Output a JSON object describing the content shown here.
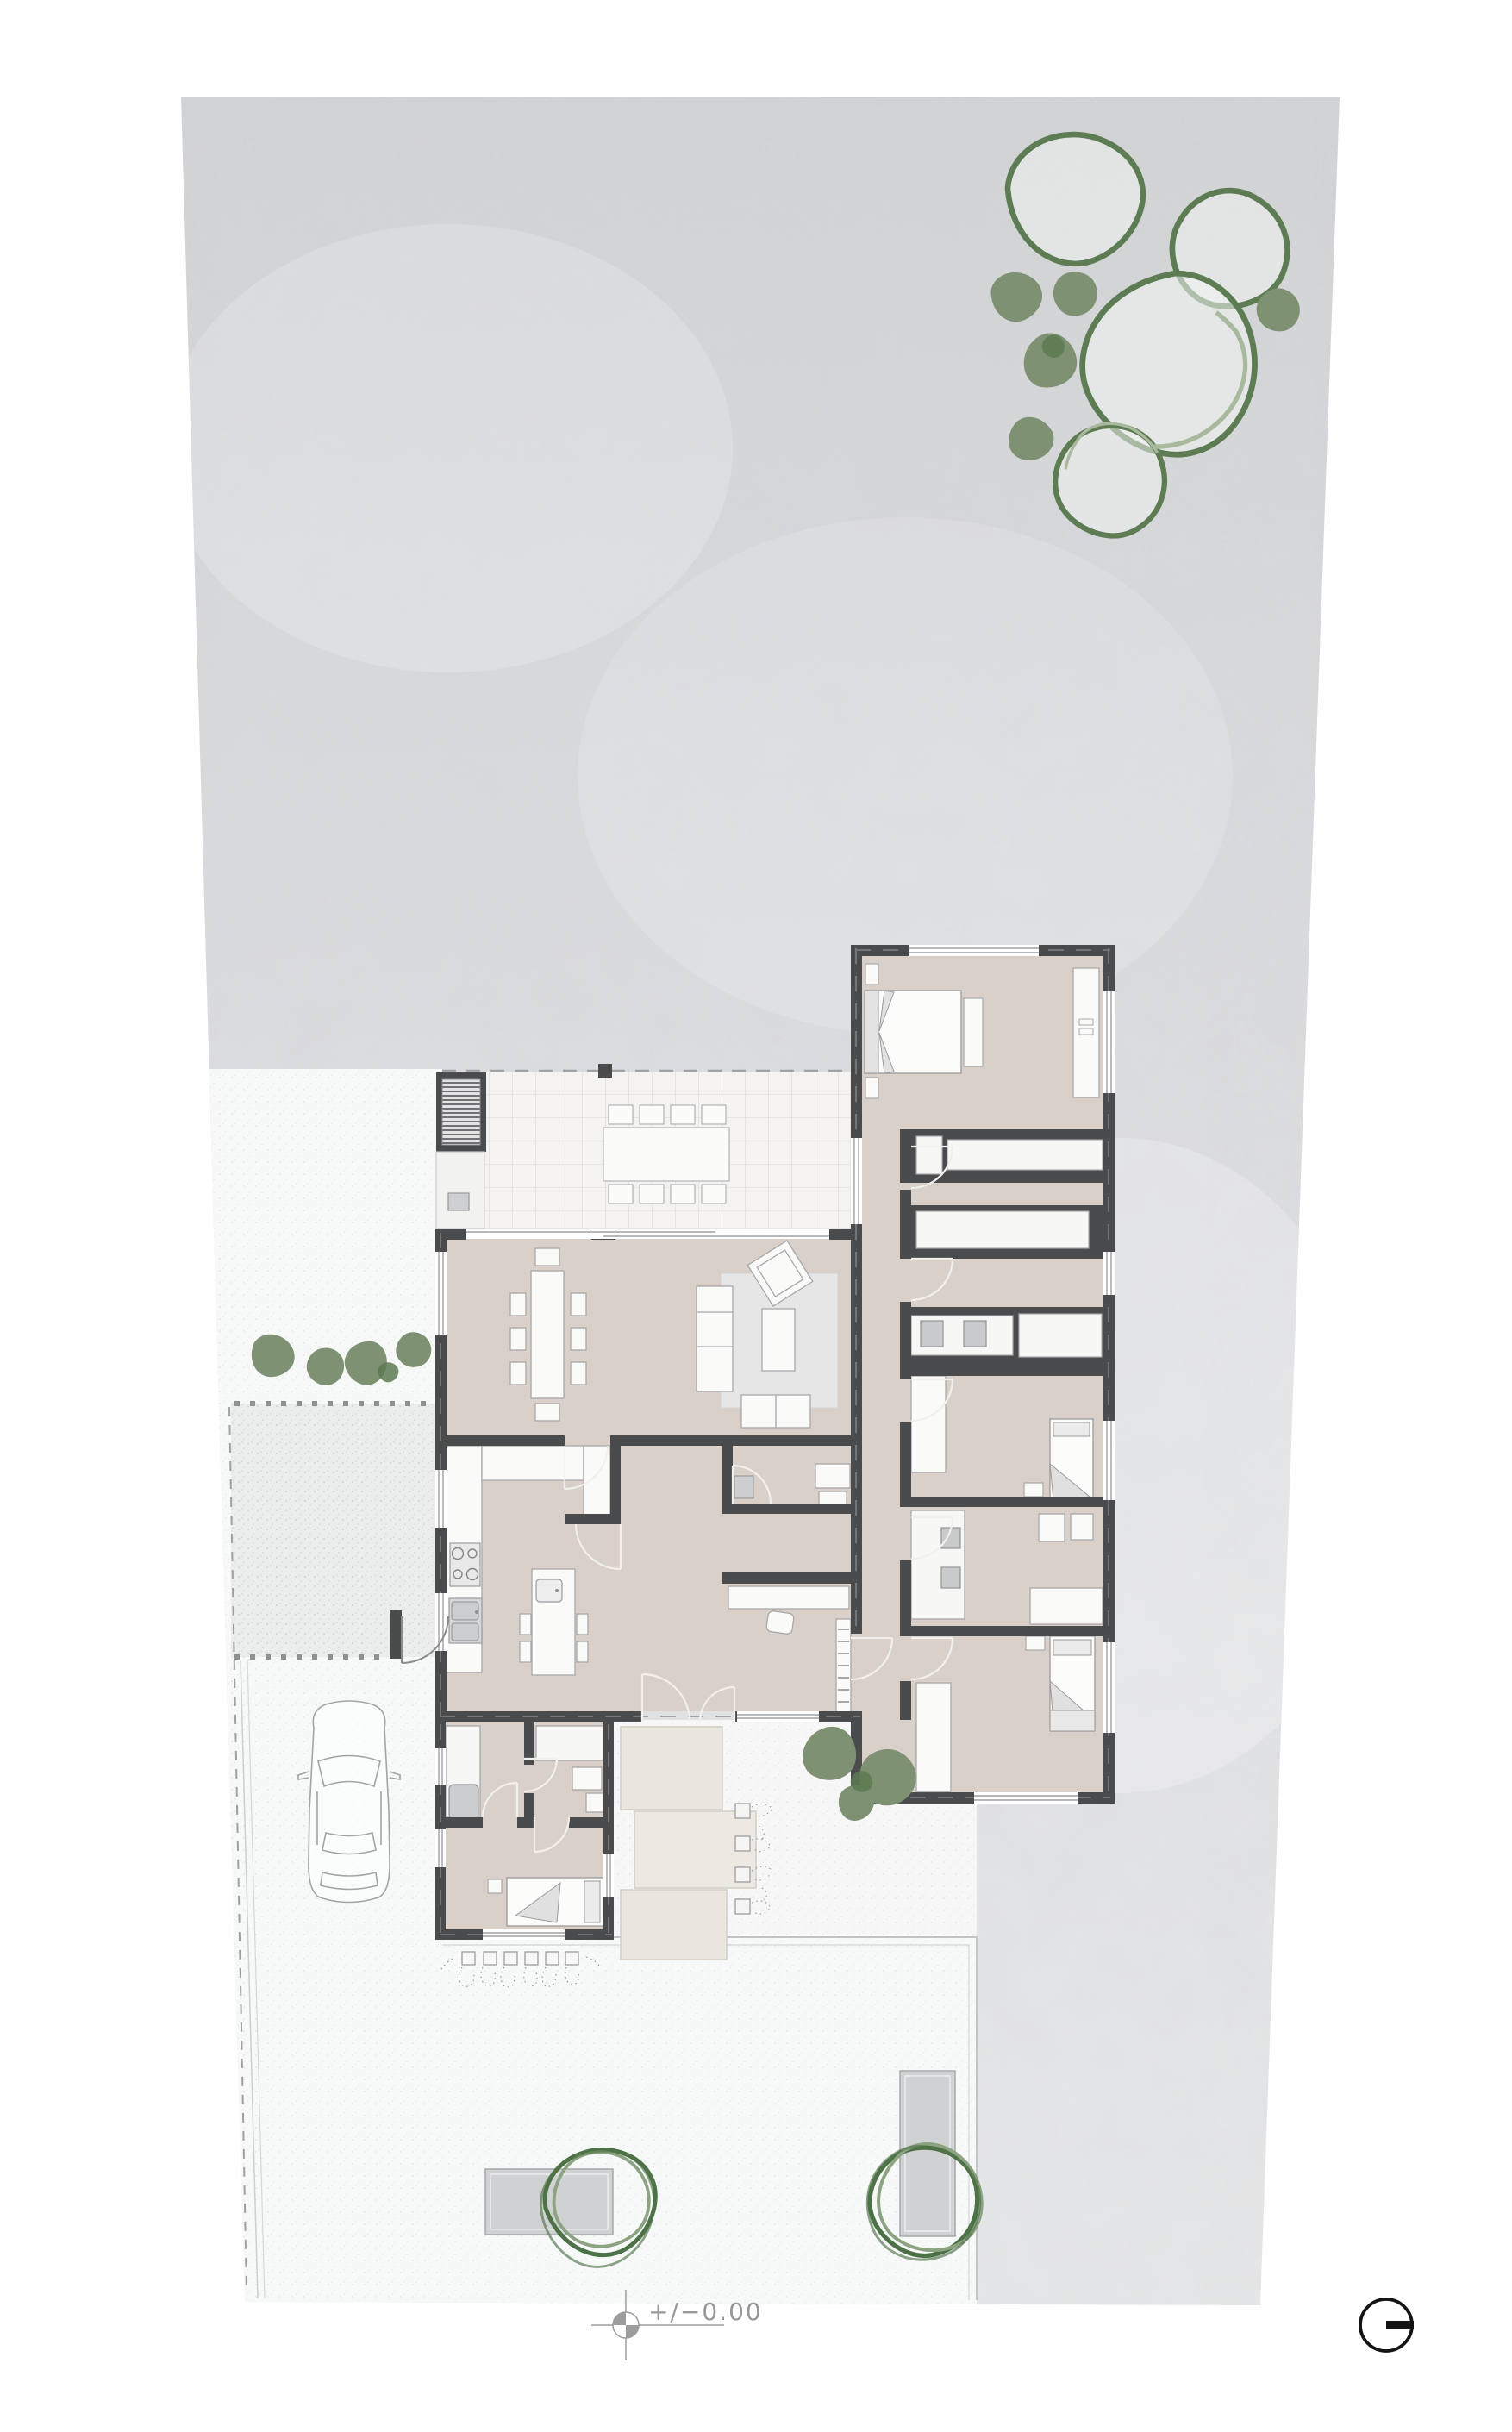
{
  "document": {
    "type": "architectural-site-plan",
    "description": "Ground-floor plan of a single-storey house on a trapezoidal parcel with garden, driveway, car, trees and annotations"
  },
  "annotations": {
    "level_marker_label": "+/−0.00",
    "level_marker_symbol": "datum-crosshair-circle-icon",
    "north_symbol": "circle-with-bar-icon"
  },
  "colors": {
    "page_background": "#ffffff",
    "site_fill_top": "#d1d3d5",
    "site_fill_bottom": "#e7e8e9",
    "paving_white": "#f7f8f8",
    "gravel": "#ebecec",
    "wall": "#4a4b4d",
    "room_floor": "#d9d1c9",
    "terrace_tile": "#f4f3f1",
    "stone_path": "#e9e6df",
    "furniture_fill": "#fafaf9",
    "furniture_stroke": "#a8a8aa",
    "appliance_gray": "#cdcecf",
    "rug": "#e6e6e7",
    "tree_outline": "#5e7c54",
    "tree_inner": "#a9b99d",
    "bush_fill": "#7e9172",
    "bush_dark": "#5d7a52",
    "scribble_tree_dark": "#4e7247",
    "scribble_tree_light": "#8ca381",
    "annotation_gray": "#9c9d9f",
    "north_black": "#141414"
  },
  "elements": {
    "trees_top_right": 4,
    "bushes_top_right": 5,
    "bushes_left_of_house": 4,
    "bushes_at_entrance": 3,
    "garden_trees_with_planters": 2,
    "flower_beds": 6,
    "path_planter_boxes": 4,
    "cars": 1
  }
}
